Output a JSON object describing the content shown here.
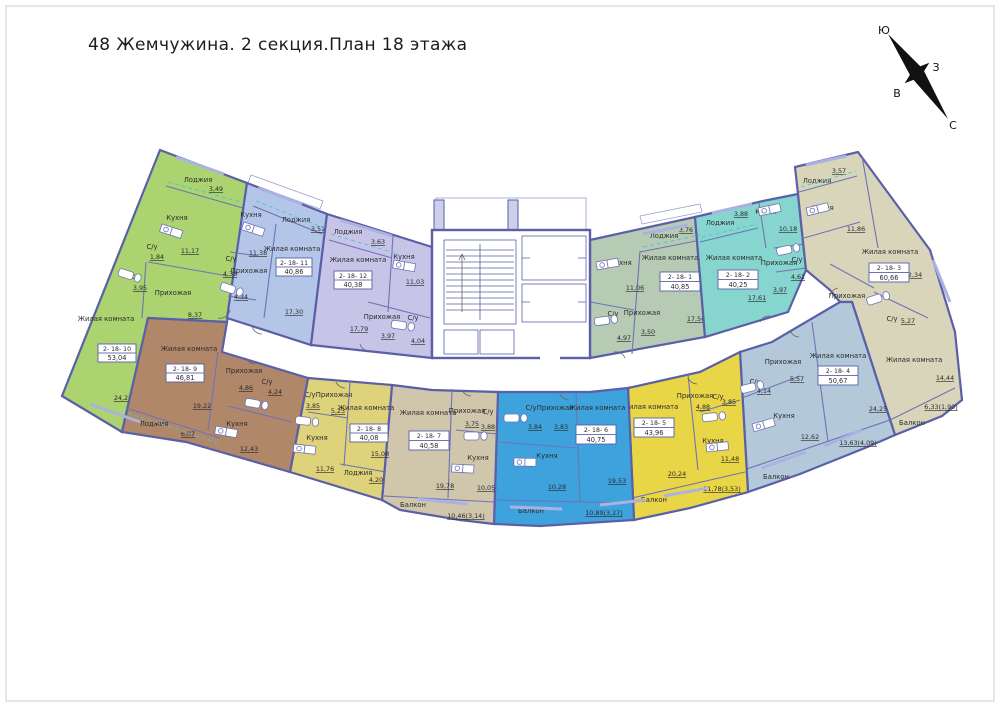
{
  "title": "48 Жемчужина.  2 секция.План 18 этажа",
  "compass": {
    "s": "Ю",
    "w": "З",
    "e": "В",
    "n": "С"
  },
  "apartments": [
    {
      "id": "2- 18- 1",
      "total": "40,85",
      "color": "#b7cbb4",
      "rooms": [
        {
          "n": "Кухня",
          "a": "11,06"
        },
        {
          "n": "Лоджия",
          "a": "3,76"
        },
        {
          "n": "Жилая комната",
          "a": "17,56"
        },
        {
          "n": "Прихожая",
          "a": "3,50"
        },
        {
          "n": "С/у",
          "a": "4,97"
        }
      ]
    },
    {
      "id": "2- 18- 2",
      "total": "40,25",
      "color": "#86d5cf",
      "rooms": [
        {
          "n": "Кухня",
          "a": "10,18"
        },
        {
          "n": "Лоджия",
          "a": "3,88"
        },
        {
          "n": "Жилая комната",
          "a": "17,61"
        },
        {
          "n": "Прихожая",
          "a": "3,97"
        },
        {
          "n": "С/у",
          "a": "4,61"
        }
      ]
    },
    {
      "id": "2- 18- 3",
      "total": "60,66",
      "color": "#d8d5ba",
      "rooms": [
        {
          "n": "Лоджия",
          "a": "3,57"
        },
        {
          "n": "Кухня",
          "a": "11,86"
        },
        {
          "n": "Жилая комната",
          "a": "12,34"
        },
        {
          "n": "Прихожая",
          "a": ""
        },
        {
          "n": "С/у",
          "a": "5,27"
        },
        {
          "n": "Жилая комната",
          "a": "14,44"
        },
        {
          "n": "Балкон",
          "a": "6,33(1,90)"
        }
      ]
    },
    {
      "id": "2- 18- 4",
      "total": "50,67",
      "color": "#b3c9da",
      "rooms": [
        {
          "n": "Прихожая",
          "a": "5,57"
        },
        {
          "n": "С/у",
          "a": "4,14"
        },
        {
          "n": "Кухня",
          "a": "12,62"
        },
        {
          "n": "Жилая комната",
          "a": "24,25"
        },
        {
          "n": "Балкон",
          "a": "13,63(4,09)"
        }
      ]
    },
    {
      "id": "2- 18- 5",
      "total": "43,96",
      "color": "#e9d647",
      "rooms": [
        {
          "n": "Жилая комната",
          "a": "20,24"
        },
        {
          "n": "Прихожая",
          "a": "4,88"
        },
        {
          "n": "С/у",
          "a": "3,85"
        },
        {
          "n": "Кухня",
          "a": "11,48"
        },
        {
          "n": "Балкон",
          "a": "11,78(3,53)"
        }
      ]
    },
    {
      "id": "2- 18- 6",
      "total": "40,75",
      "color": "#3ea3dc",
      "rooms": [
        {
          "n": "Жилая комната",
          "a": "19,53"
        },
        {
          "n": "Прихожая",
          "a": "3,83"
        },
        {
          "n": "С/у",
          "a": "3,84"
        },
        {
          "n": "Кухня",
          "a": "10,28"
        },
        {
          "n": "Балкон",
          "a": "10,89(3,27)"
        }
      ]
    },
    {
      "id": "2- 18- 7",
      "total": "40,58",
      "color": "#cfc6ac",
      "rooms": [
        {
          "n": "Жилая комната",
          "a": "19,78"
        },
        {
          "n": "Прихожая",
          "a": "3,75"
        },
        {
          "n": "С/у",
          "a": "3,88"
        },
        {
          "n": "Кухня",
          "a": "10,05"
        },
        {
          "n": "Балкон",
          "a": "10,46(3,14)"
        }
      ]
    },
    {
      "id": "2- 18- 8",
      "total": "40,08",
      "color": "#ded37b",
      "rooms": [
        {
          "n": "Прихожая",
          "a": "5,23"
        },
        {
          "n": "С/у",
          "a": "3,85"
        },
        {
          "n": "Кухня",
          "a": "11,76"
        },
        {
          "n": "Жилая комната",
          "a": "15,08"
        },
        {
          "n": "Лоджия",
          "a": "4,20"
        }
      ]
    },
    {
      "id": "2- 18- 9",
      "total": "46,81",
      "color": "#b1876a",
      "rooms": [
        {
          "n": "Жилая комната",
          "a": "19,22"
        },
        {
          "n": "Прихожая",
          "a": "4,86"
        },
        {
          "n": "С/у",
          "a": "4,24"
        },
        {
          "n": "Кухня",
          "a": "12,43"
        },
        {
          "n": "Лоджия",
          "a": "6,07"
        }
      ]
    },
    {
      "id": "2- 18- 10",
      "total": "53,04",
      "color": "#abd36f",
      "rooms": [
        {
          "n": "Лоджия",
          "a": "3,49"
        },
        {
          "n": "Кухня",
          "a": "11,17"
        },
        {
          "n": "С/у",
          "a": "1,84"
        },
        {
          "n": "С/у",
          "a": "3,95"
        },
        {
          "n": "Прихожая",
          "a": "8,37"
        },
        {
          "n": "Жилая комната",
          "a": "24,22"
        }
      ]
    },
    {
      "id": "2- 18- 11",
      "total": "40,86",
      "color": "#b4c6e8",
      "rooms": [
        {
          "n": "Кухня",
          "a": "11,38"
        },
        {
          "n": "С/у",
          "a": "4,38"
        },
        {
          "n": "Прихожая",
          "a": "4,34"
        },
        {
          "n": "Жилая комната",
          "a": "17,30"
        },
        {
          "n": "Лоджия",
          "a": "3,51"
        }
      ]
    },
    {
      "id": "2- 18- 12",
      "total": "40,38",
      "color": "#c7c4e8",
      "rooms": [
        {
          "n": "Лоджия",
          "a": "3,63"
        },
        {
          "n": "Жилая комната",
          "a": "17,79"
        },
        {
          "n": "Кухня",
          "a": "11,03"
        },
        {
          "n": "Прихожая",
          "a": "3,97"
        },
        {
          "n": "С/у",
          "a": "4,04"
        }
      ]
    }
  ]
}
